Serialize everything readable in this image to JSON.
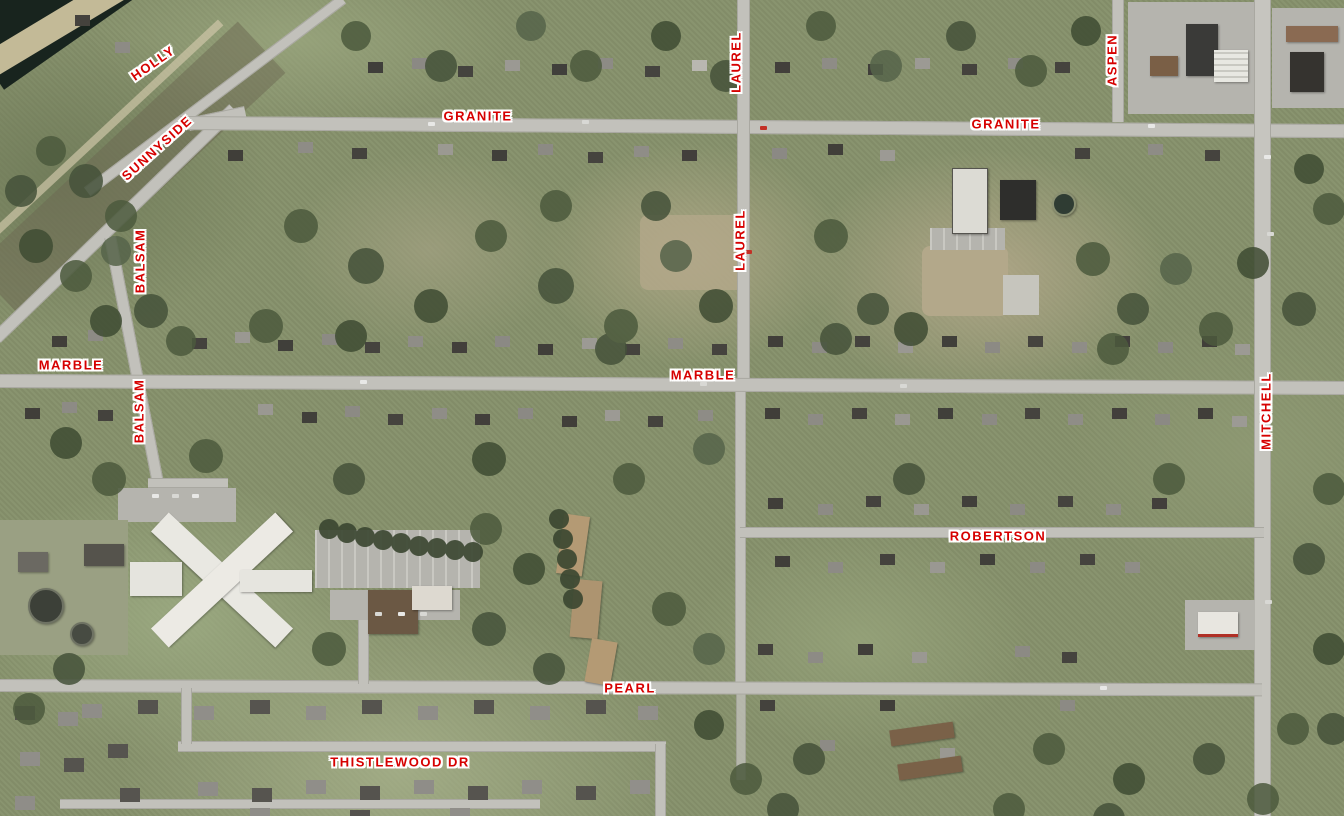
{
  "map": {
    "description": "Aerial orthophoto of a residential neighborhood with red street-name overlays",
    "label_color": "#d60000",
    "label_halo_color": "#ffffff",
    "street_labels": [
      {
        "id": "holly",
        "text": "HOLLY"
      },
      {
        "id": "sunnyside",
        "text": "SUNNYSIDE"
      },
      {
        "id": "granite-west",
        "text": "GRANITE"
      },
      {
        "id": "laurel-north",
        "text": "LAUREL"
      },
      {
        "id": "granite-east",
        "text": "GRANITE"
      },
      {
        "id": "aspen",
        "text": "ASPEN"
      },
      {
        "id": "balsam-north",
        "text": "BALSAM"
      },
      {
        "id": "marble-west",
        "text": "MARBLE"
      },
      {
        "id": "laurel-mid",
        "text": "LAUREL"
      },
      {
        "id": "marble-central",
        "text": "MARBLE"
      },
      {
        "id": "balsam-south",
        "text": "BALSAM"
      },
      {
        "id": "mitchell",
        "text": "MITCHELL"
      },
      {
        "id": "robertson",
        "text": "ROBERTSON"
      },
      {
        "id": "pearl",
        "text": "PEARL"
      },
      {
        "id": "thistlewood-dr",
        "text": "THISTLEWOOD DR"
      }
    ]
  }
}
